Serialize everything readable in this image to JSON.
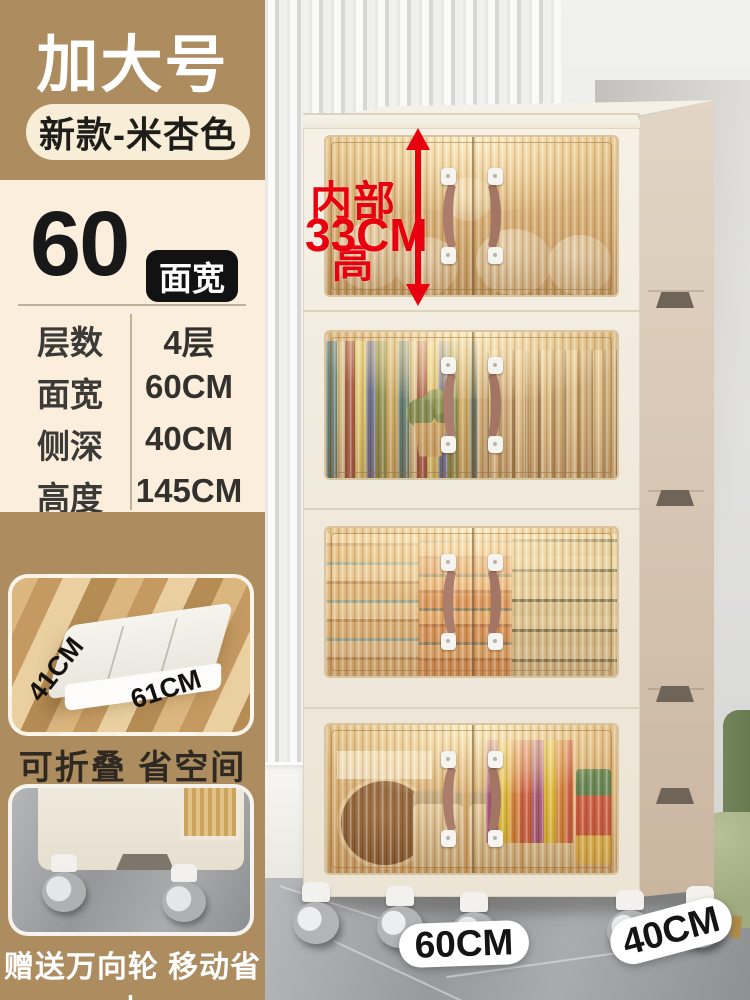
{
  "header": {
    "size_badge": "加大号",
    "variant_badge": "新款-米杏色"
  },
  "width_callout": {
    "number": "60",
    "label": "面宽"
  },
  "specs": {
    "rows": [
      {
        "label": "层数",
        "value": "4层"
      },
      {
        "label": "面宽",
        "value": "60CM"
      },
      {
        "label": "侧深",
        "value": "40CM"
      },
      {
        "label": "高度",
        "value": "145CM"
      }
    ]
  },
  "annotation": {
    "title": "内部高",
    "value": "33CM"
  },
  "fold_photo": {
    "depth_label": "41CM",
    "width_label": "61CM",
    "caption": "可折叠 省空间"
  },
  "wheels_photo": {
    "caption": "赠送万向轮 移动省力"
  },
  "floor_labels": {
    "width": "60CM",
    "depth": "40CM"
  },
  "colors": {
    "panel_tan": "#ad8c60",
    "panel_cream": "#fbeedd",
    "badge_pill_bg": "#f8eed8",
    "accent_red": "#e8000e",
    "chip_black": "#121212",
    "cabinet_cream": "#f2ecdf",
    "cabinet_side_taupe": "#d5c4b1",
    "glass_amber": "#caa26a",
    "handle_brown": "#aa7d6d"
  }
}
